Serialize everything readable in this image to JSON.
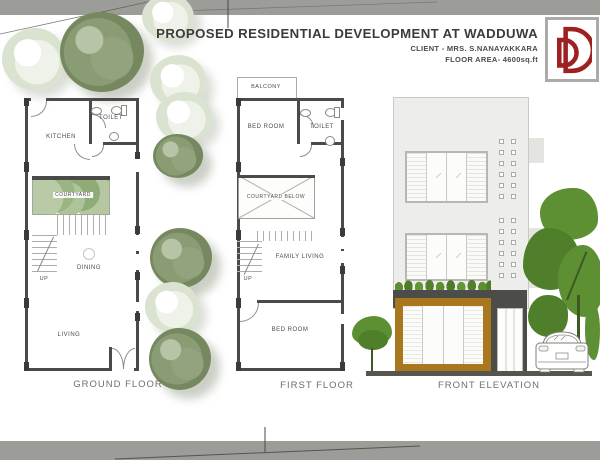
{
  "header": {
    "title": "PROPOSED RESIDENTIAL DEVELOPMENT AT WADDUWA",
    "client": "CLIENT - MRS. S.NANAYAKKARA",
    "floor_area": "FLOOR AREA- 4600sq.ft"
  },
  "logo": {
    "icon": "double-d-monogram-icon",
    "color": "#9e2020"
  },
  "plans": {
    "ground": {
      "caption": "GROUND FLOOR",
      "kitchen": "KITCHEN",
      "toilet": "TOILET",
      "courtyard": "COURTYARD",
      "dining": "DINING",
      "living": "LIVING",
      "up": "UP"
    },
    "first": {
      "caption": "FIRST FLOOR",
      "balcony": "BALCONY",
      "bedroom_top": "BED ROOM",
      "toilet": "TOILET",
      "courtyard_below": "COURTYARD BELOW",
      "family_living": "FAMILY LIVING",
      "bedroom_bottom": "BED ROOM",
      "up": "UP"
    }
  },
  "elevation": {
    "caption": "FRONT ELEVATION"
  },
  "colors": {
    "wall_dark": "#4a4a48",
    "accent_red": "#9e2020",
    "window_frame_brown": "#a8771e",
    "elevation_tree_green": "#5d8f33",
    "border_band_gray": "#9c9c99"
  }
}
